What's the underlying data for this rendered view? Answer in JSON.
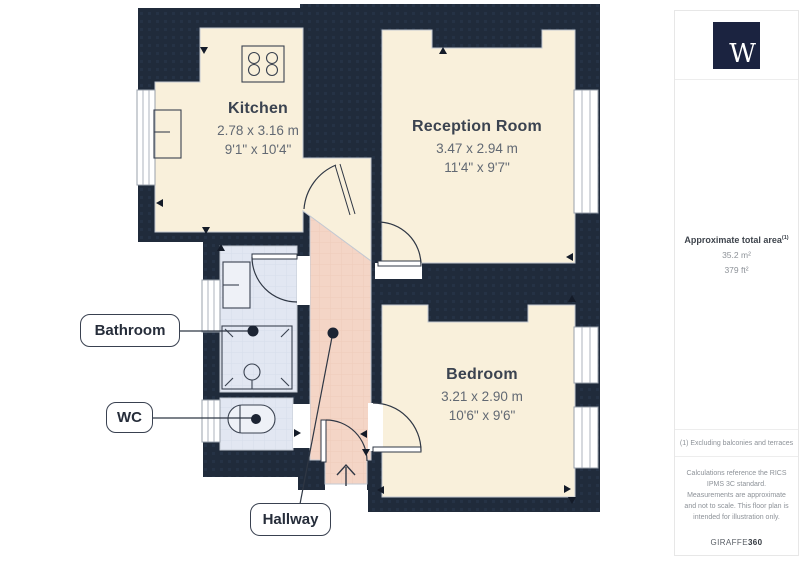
{
  "floorplan": {
    "rooms": [
      {
        "name": "Kitchen",
        "dim_m": "2.78 x 3.16 m",
        "dim_ft": "9'1\" x 10'4\""
      },
      {
        "name": "Reception Room",
        "dim_m": "3.47 x 2.94 m",
        "dim_ft": "11'4\" x 9'7\""
      },
      {
        "name": "Bedroom",
        "dim_m": "3.21 x 2.90 m",
        "dim_ft": "10'6\" x 9'6\""
      }
    ],
    "callouts": [
      {
        "text": "Bathroom"
      },
      {
        "text": "WC"
      },
      {
        "text": "Hallway"
      }
    ]
  },
  "sidebar": {
    "logo_letter": "W",
    "area_title": "Approximate total area",
    "area_note_ref": "(1)",
    "area_metric": "35.2 m²",
    "area_imperial": "379 ft²",
    "footnote": "(1) Excluding balconies and terraces",
    "disclaimer": "Calculations reference the RICS IPMS 3C standard. Measurements are approximate and not to scale. This floor plan is intended for illustration only.",
    "brand_name": "GIRAFFE",
    "brand_suffix": "360"
  },
  "colors": {
    "wall": "#202b3b",
    "room_cream": "#f9f0db",
    "hallway_pink": "#f4d5c6",
    "wet_room_blue": "#e2e7f2",
    "logo_navy": "#1b2340"
  }
}
